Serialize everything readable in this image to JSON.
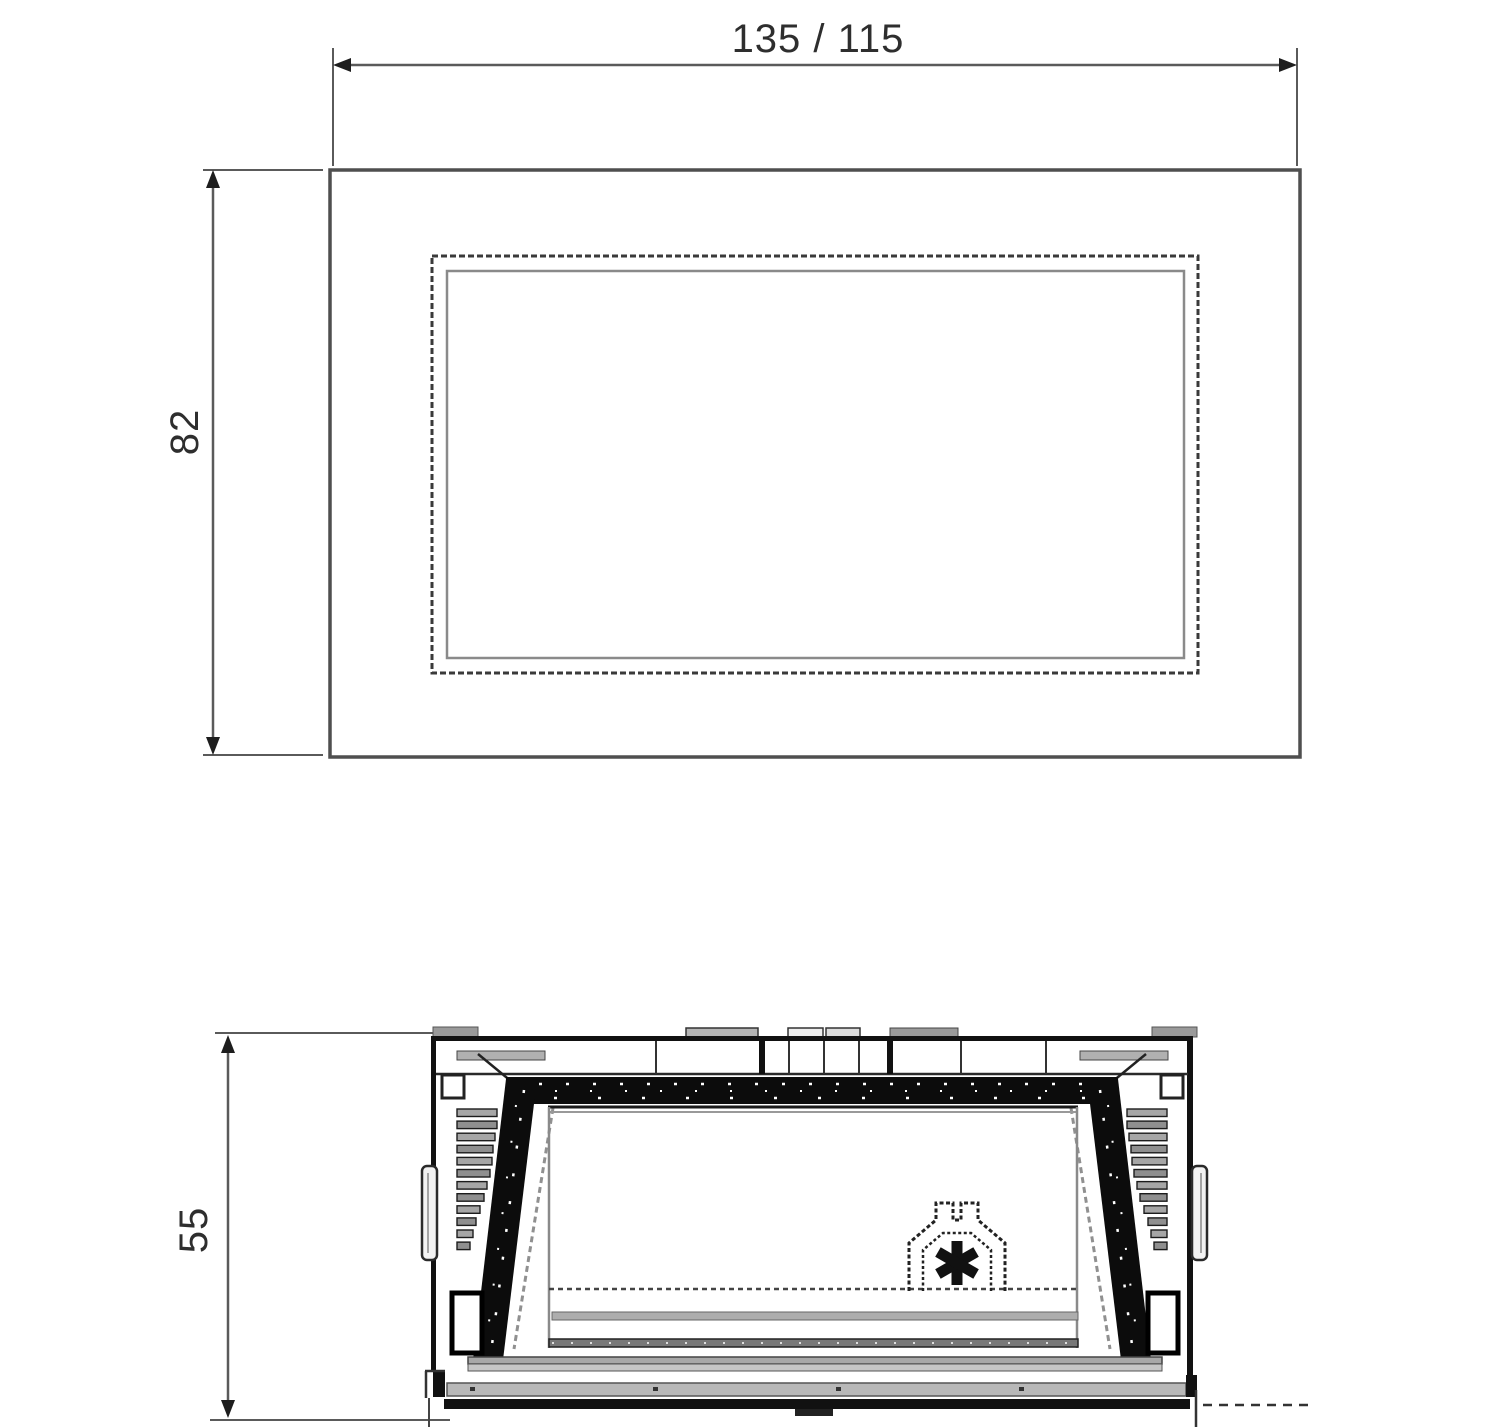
{
  "dimensions": {
    "width_label": "135  /  115",
    "height_label": "82",
    "depth_label": "55"
  },
  "colors": {
    "background": "#ffffff",
    "outline": "#4f4f4f",
    "dimension_line": "#5a5a5a",
    "dimension_text": "#2e2e2e",
    "fill_black": "#0c0c0c",
    "fill_gray": "#9c9c9c"
  }
}
